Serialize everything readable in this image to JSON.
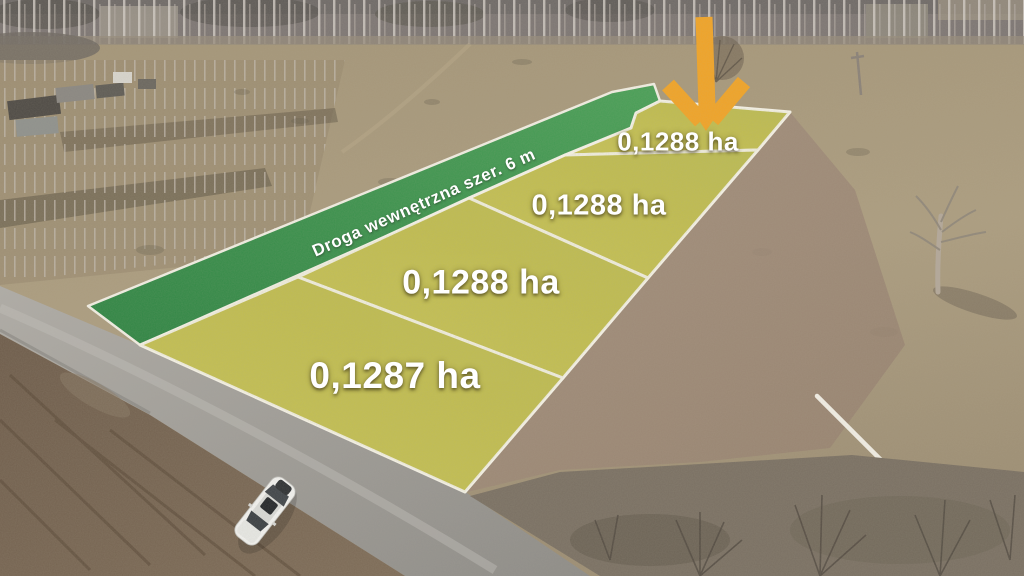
{
  "image": {
    "kind": "aerial-drone-photo-of-land-plots",
    "season_hint": "early-spring bare trees"
  },
  "overlay": {
    "road_label": "Droga wewnętrzna szer. 6 m",
    "plots": [
      {
        "id": "plot-1",
        "area_label": "0,1288 ha"
      },
      {
        "id": "plot-2",
        "area_label": "0,1288 ha"
      },
      {
        "id": "plot-3",
        "area_label": "0,1288 ha"
      },
      {
        "id": "plot-4",
        "area_label": "0,1287 ha"
      }
    ],
    "icons": [
      {
        "name": "highlight-arrow-icon",
        "glyph": "chunky down arrow",
        "color": "#F1A427"
      }
    ],
    "colors": {
      "arrow": "#F1A427",
      "internal_road_strip": "#36904C",
      "plot_fill": "#C3BF4F",
      "boundary_line": "#F6F3E8"
    }
  }
}
